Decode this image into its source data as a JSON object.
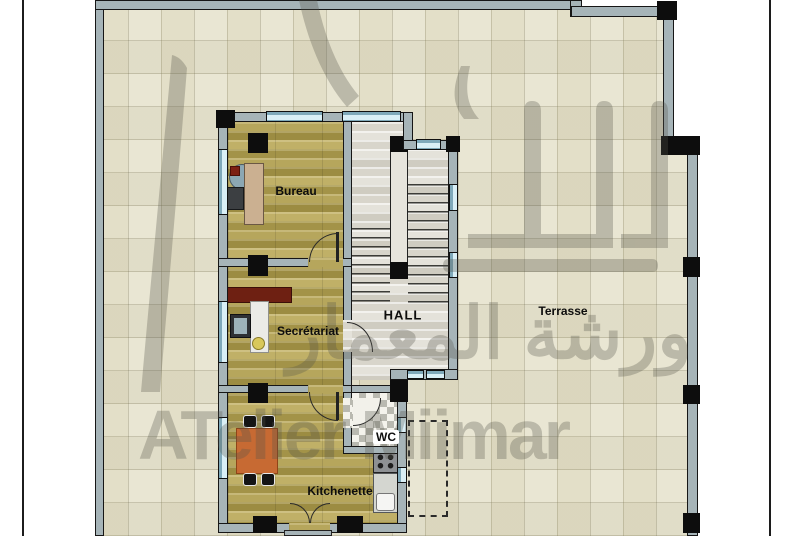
{
  "page": {
    "background": "#ffffff",
    "border_color": "#1c1c1c"
  },
  "site": {
    "tile_color": "#e9e6d3",
    "wall_color": "#a6b4b8",
    "outline_color": "#161616"
  },
  "rooms": {
    "bureau": {
      "label": "Bureau"
    },
    "secretariat": {
      "label": "Secrétariat"
    },
    "hall": {
      "label": "HALL"
    },
    "terrasse": {
      "label": "Terrasse"
    },
    "wc": {
      "label": "WC"
    },
    "kitchenette": {
      "label": "Kitchenette"
    }
  },
  "watermark": {
    "latin": "ATelier Miimar",
    "arabic": "ورشة المعمار",
    "color": "#54544a"
  },
  "colors": {
    "wood_floor": "#ab9b4f",
    "hall_floor": "#dcd9d0",
    "window_glass": "#d9eff6",
    "table": "#c76a33",
    "credenza": "#6e2012",
    "desk": "#cbb091",
    "column": "#0d0d0d"
  }
}
